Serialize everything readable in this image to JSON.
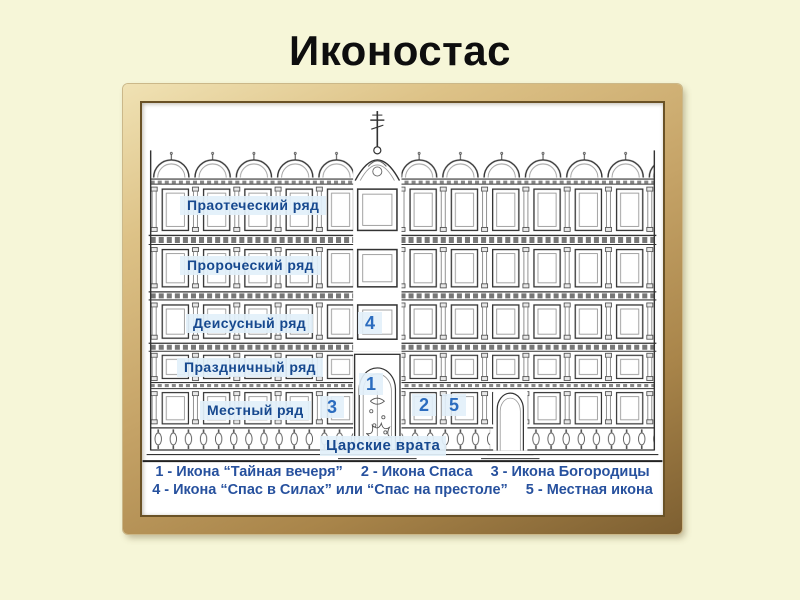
{
  "title": "Иконостас",
  "diagram": {
    "rows": [
      {
        "id": "praotechesky",
        "label": "Праотеческий ряд"
      },
      {
        "id": "prorochesky",
        "label": "Пророческий ряд"
      },
      {
        "id": "deisusny",
        "label": "Деисусный ряд"
      },
      {
        "id": "prazdnichny",
        "label": "Праздничный ряд"
      },
      {
        "id": "mestny",
        "label": "Местный ряд"
      }
    ],
    "gates_label": "Царские врата",
    "markers": {
      "m1": "1",
      "m2": "2",
      "m3": "3",
      "m4": "4",
      "m5": "5"
    }
  },
  "legend": {
    "line1_items": [
      "1 - Икона “Тайная вечеря”",
      "2 - Икона Спаса",
      "3 - Икона Богородицы"
    ],
    "line2_items": [
      "4 - Икона “Спас в Силах” или “Спас на престоле”",
      "5 - Местная икона"
    ]
  },
  "colors": {
    "background": "#f6f6d8",
    "title": "#0e0e0e",
    "label_blue": "#17498f",
    "marker_blue": "#2b6cbf",
    "legend_blue": "#27519e",
    "frame_gold": "#c6a468",
    "drawing_ink": "#333333"
  }
}
